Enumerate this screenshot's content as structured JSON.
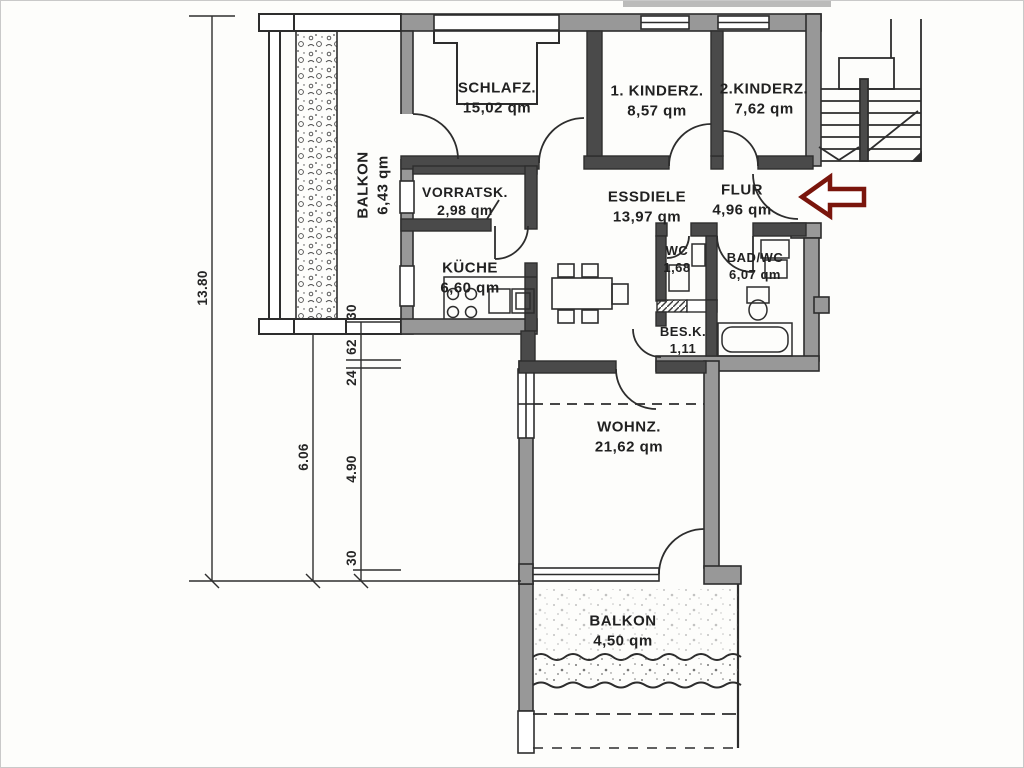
{
  "rooms": {
    "schlafzimmer": {
      "name": "SCHLAFZ.",
      "area": "15,02 qm"
    },
    "kinderzimmer1": {
      "name": "1. KINDERZ.",
      "area": "8,57 qm"
    },
    "kinderzimmer2": {
      "name": "2.KINDERZ.",
      "area": "7,62 qm"
    },
    "vorratskammer": {
      "name": "VORRATSK.",
      "area": "2,98 qm"
    },
    "essdiele": {
      "name": "ESSDIELE",
      "area": "13,97 qm"
    },
    "flur": {
      "name": "FLUR",
      "area": "4,96 qm"
    },
    "kueche": {
      "name": "KÜCHE",
      "area": "6,60 qm"
    },
    "wc": {
      "name": "WC",
      "area": "1,68"
    },
    "bad_wc": {
      "name": "BAD/WC",
      "area": "6,07 qm"
    },
    "besenkammer": {
      "name": "BES.K.",
      "area": "1,11"
    },
    "wohnzimmer": {
      "name": "WOHNZ.",
      "area": "21,62 qm"
    },
    "balkon_west": {
      "name": "BALKON",
      "area": "6,43 qm"
    },
    "balkon_sued": {
      "name": "BALKON",
      "area": "4,50 qm"
    }
  },
  "dimensions": {
    "gesamt_hoehe": "13.80",
    "balkon_laenge": "6.06",
    "wohnzimmer_breite": "4.90",
    "wand_oben": "30",
    "wand_62": "62",
    "wand_24": "24",
    "wand_unten": "30"
  },
  "colors": {
    "ink": "#2d2d2d",
    "wall_fill": "#989898",
    "arrow_red": "#7a150c"
  }
}
